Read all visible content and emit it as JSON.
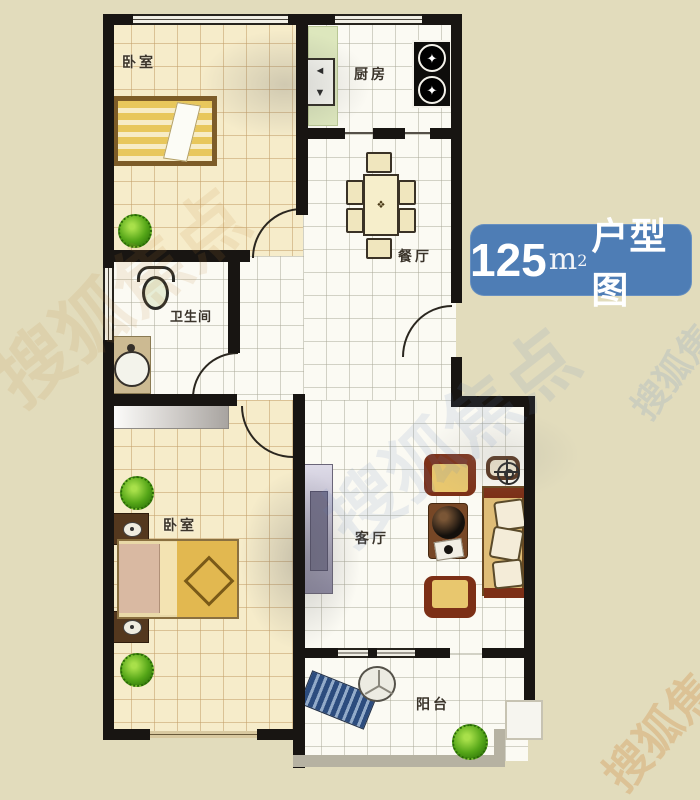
{
  "badge": {
    "area_value": "125",
    "area_unit": "m",
    "area_unit_sup": "2",
    "suffix": "户型图",
    "bg_color": "#4e7db5",
    "text_color": "#ffffff"
  },
  "rooms": {
    "bedroom_top": {
      "label": "卧室"
    },
    "kitchen": {
      "label": "厨房"
    },
    "dining": {
      "label": "餐厅"
    },
    "bathroom": {
      "label": "卫生间"
    },
    "bedroom_bottom": {
      "label": "卧室"
    },
    "living": {
      "label": "客厅"
    },
    "balcony": {
      "label": "阳台"
    }
  },
  "furniture_glyphs": {
    "dining_table_mark": "❖",
    "burner_mark": "✦",
    "sink_mark_top": "◄",
    "sink_mark_bottom": "▼"
  },
  "watermark": {
    "text": "搜狐焦点"
  },
  "colors": {
    "background": "#e2dcbc",
    "wall": "#181512",
    "floor_warm": "#f6ecca",
    "floor_cool": "#fbfaf3",
    "counter_green": "#dde7bd",
    "bed_yellow": "#e8c75c",
    "sofa_yellow": "#dfbd77",
    "armrest_brown": "#7c2f16",
    "plant_green": "#55a618",
    "lounge_blue": "#2c4c7e",
    "badge_blue": "#4e7db5"
  }
}
